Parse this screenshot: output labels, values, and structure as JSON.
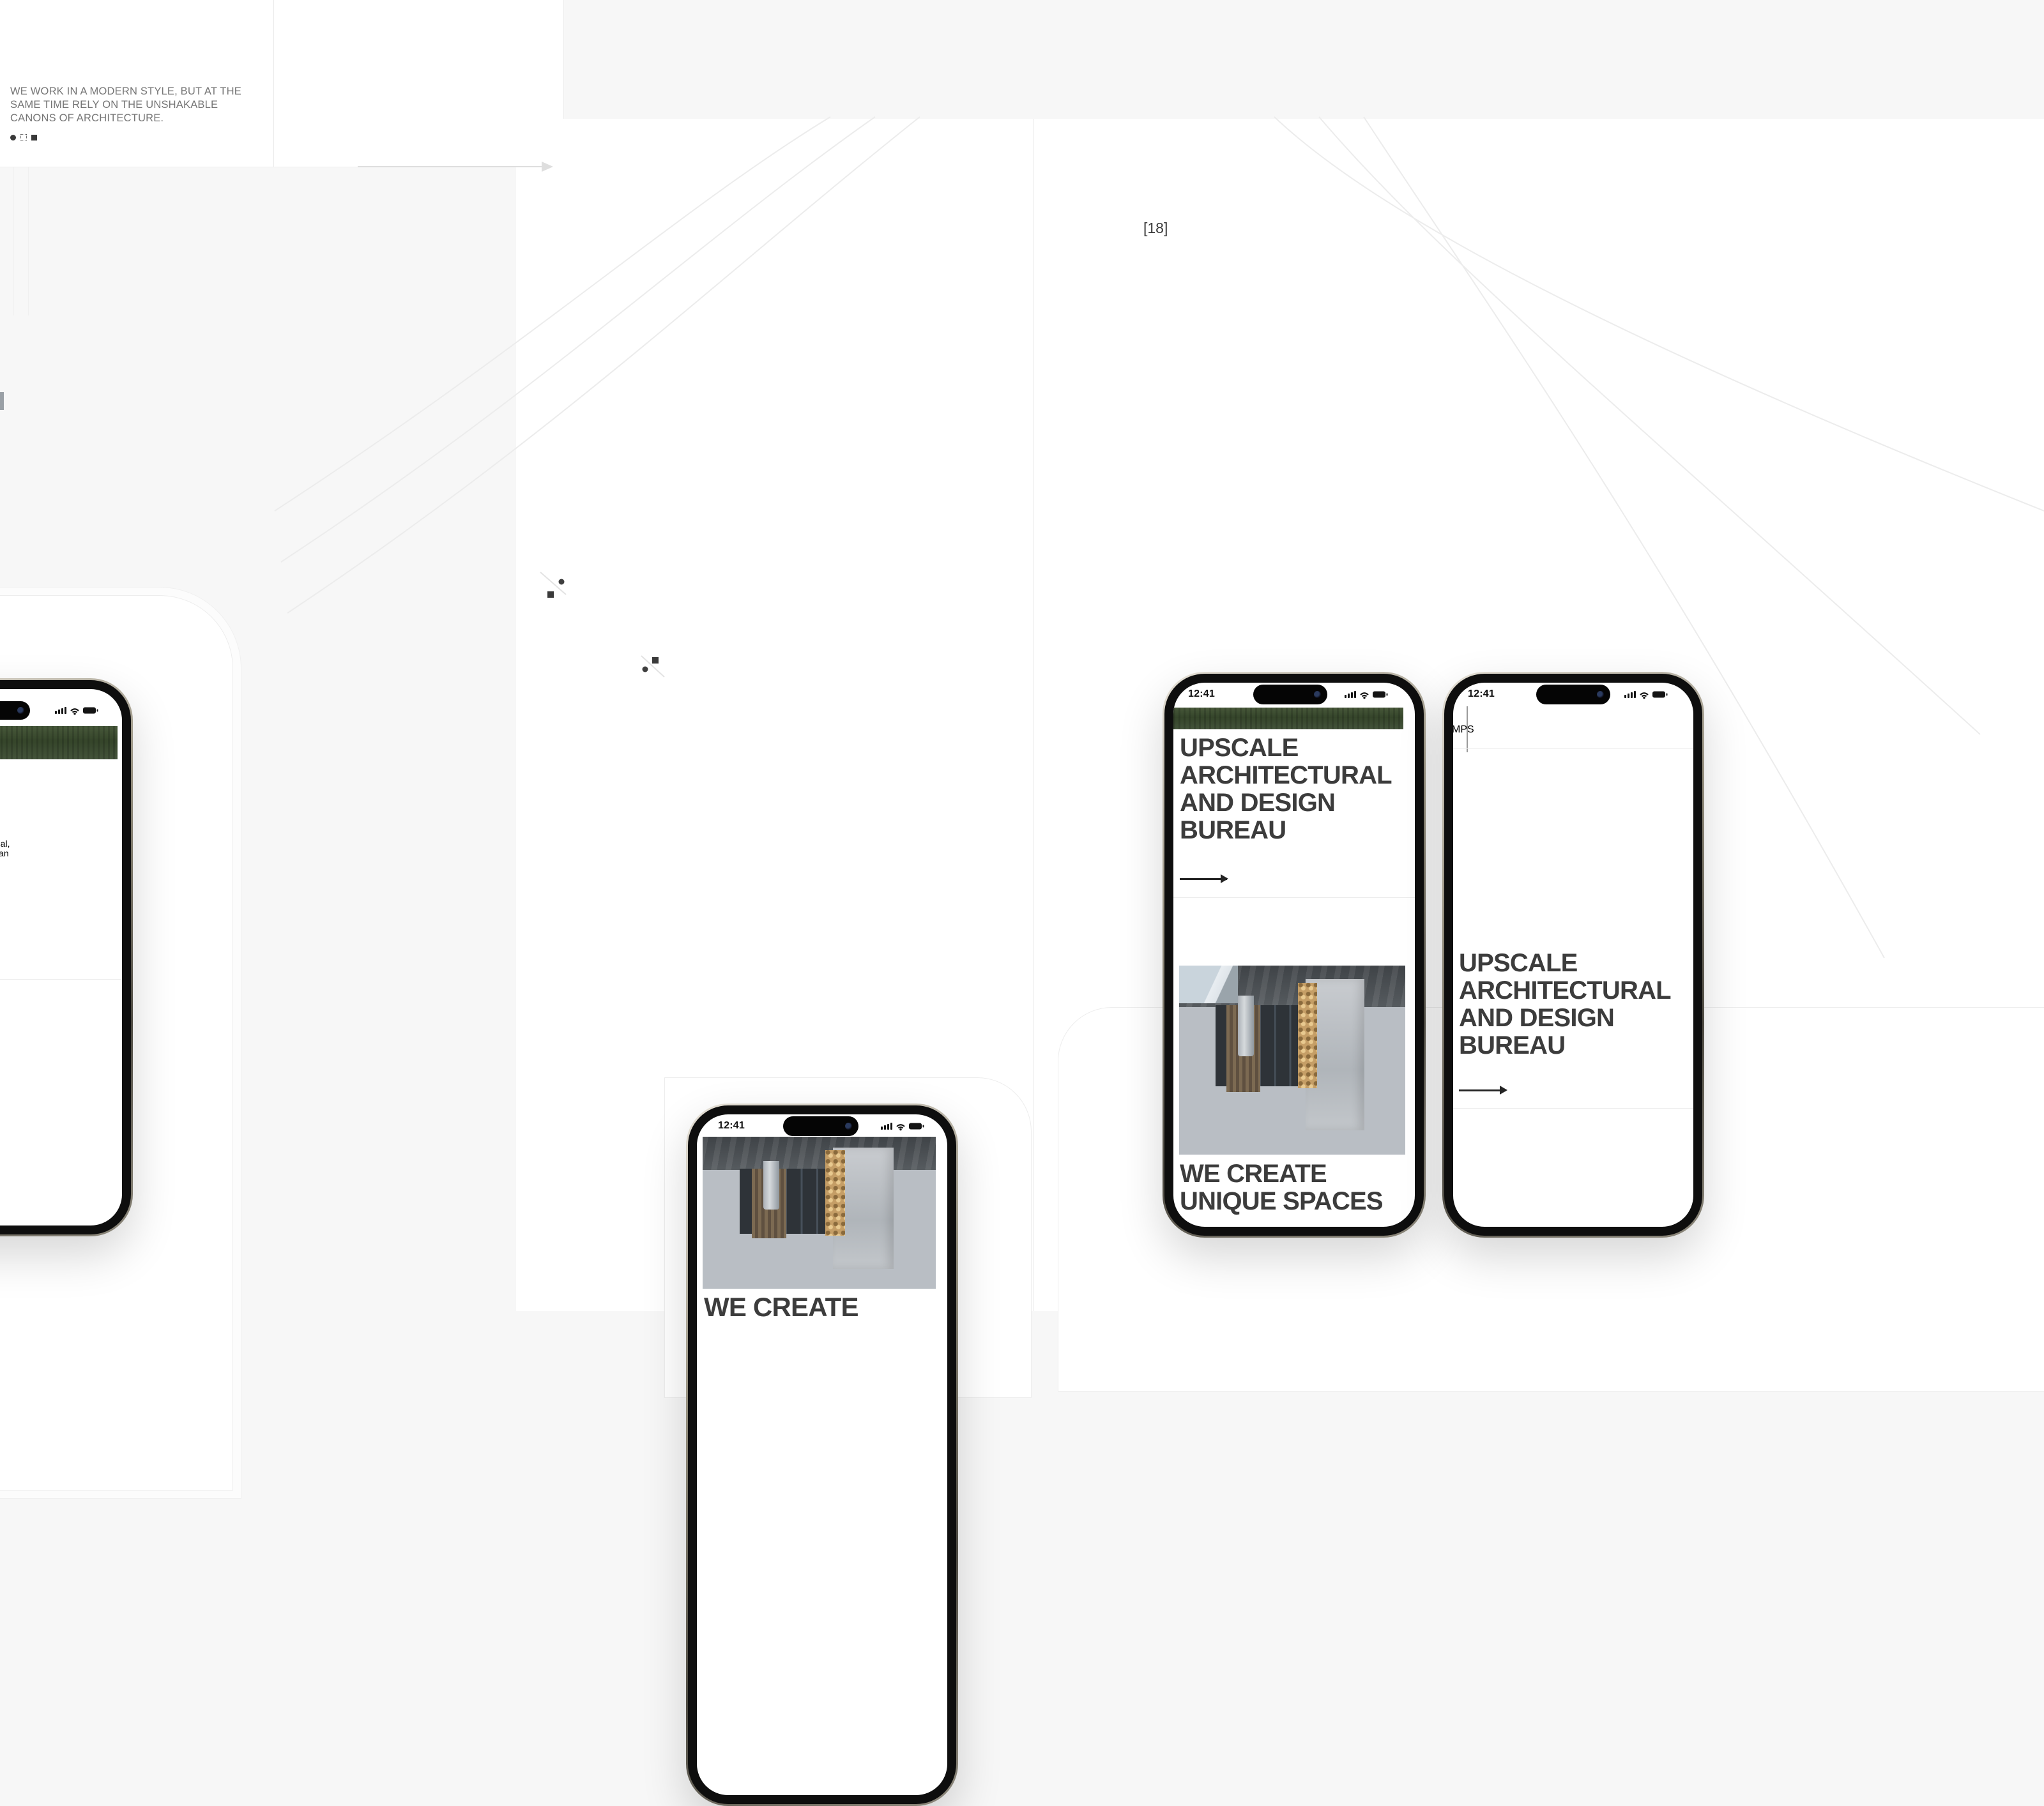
{
  "colors": {
    "canvas_bg": "#f7f7f7",
    "frame_bg": "#ffffff",
    "hairline": "#e9e9e9",
    "heading": "#3c3c3c",
    "muted_text": "#9c9c9c",
    "bracket": "#c8c8c8",
    "grass_green": "#3c4c2e",
    "fire_orange": "#f59b1e"
  },
  "top_left_frame": {
    "statement": "WE WORK IN A MODERN STYLE, BUT AT THE SAME TIME RELY ON THE UNSHAKABLE CANONS OF ARCHITECTURE."
  },
  "tablet": {
    "headline_clipped": "THE UNIQUENESS AND",
    "headline_line1": "ORIGINALITY OF THE",
    "headline_line2": "OBJECT."
  },
  "team_section": {
    "counter_open": "[",
    "counter": "18",
    "counter_close": "]",
    "avatars": [
      "woman-portrait",
      "man-portrait",
      "silhouette-portrait"
    ]
  },
  "emblem": {
    "open": "[",
    "label": "VI",
    "close": "]"
  },
  "phone_left": {
    "paragraph1": [
      "Beauty and convenience are in",
      "our projects: we think about the",
      "space, light and proportions,",
      "functionality and style."
    ],
    "paragraph2": [
      "We are committed to good",
      "architecture and we have",
      "projects in Spain, Latvia, Portugal,",
      "Switzerland and the USA. We can",
      "work remotely and on site are"
    ],
    "more_label": "MORE"
  },
  "phone_bottom_center": {
    "time": "12:41",
    "heading_line1": "WE CREATE"
  },
  "phone_right_1": {
    "time": "12:41",
    "hero": [
      "UPSCALE",
      "ARCHITECTURAL",
      "AND DESIGN",
      "BUREAU"
    ],
    "sub": [
      "WE CREATE",
      "UNIQUE SPACES"
    ]
  },
  "phone_right_2": {
    "time": "12:41",
    "logo_left": "M",
    "logo_right": "PS",
    "hero": [
      "UPSCALE",
      "ARCHITECTURAL",
      "AND DESIGN",
      "BUREAU"
    ]
  }
}
